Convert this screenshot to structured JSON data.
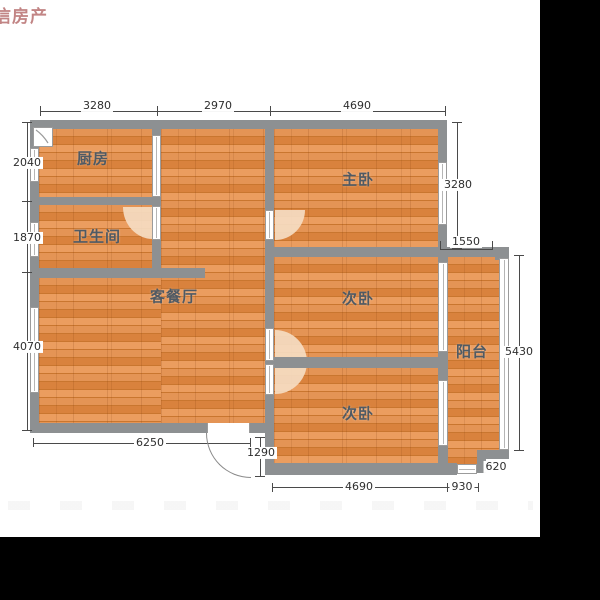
{
  "watermark": "信房产",
  "rooms": {
    "kitchen": "厨房",
    "bathroom": "卫生间",
    "living": "客餐厅",
    "master": "主卧",
    "bedroom2": "次卧",
    "bedroom3": "次卧",
    "balcony": "阳台"
  },
  "dims": {
    "top1": "3280",
    "top2": "2970",
    "top3": "4690",
    "left1": "2040",
    "left2": "1870",
    "left3": "4070",
    "right_master": "3280",
    "right_balcony_width": "1550",
    "right_height": "5430",
    "bottom_living": "6250",
    "entry_door": "1290",
    "bottom_bed": "4690",
    "bottom_balcony": "930",
    "notch": "620"
  },
  "colors": {
    "wall": "#8d9092",
    "wood": "#dd8a47",
    "watermark": "#c28585",
    "door_arc": "#f5dcc2",
    "letterbox": "#000000"
  }
}
